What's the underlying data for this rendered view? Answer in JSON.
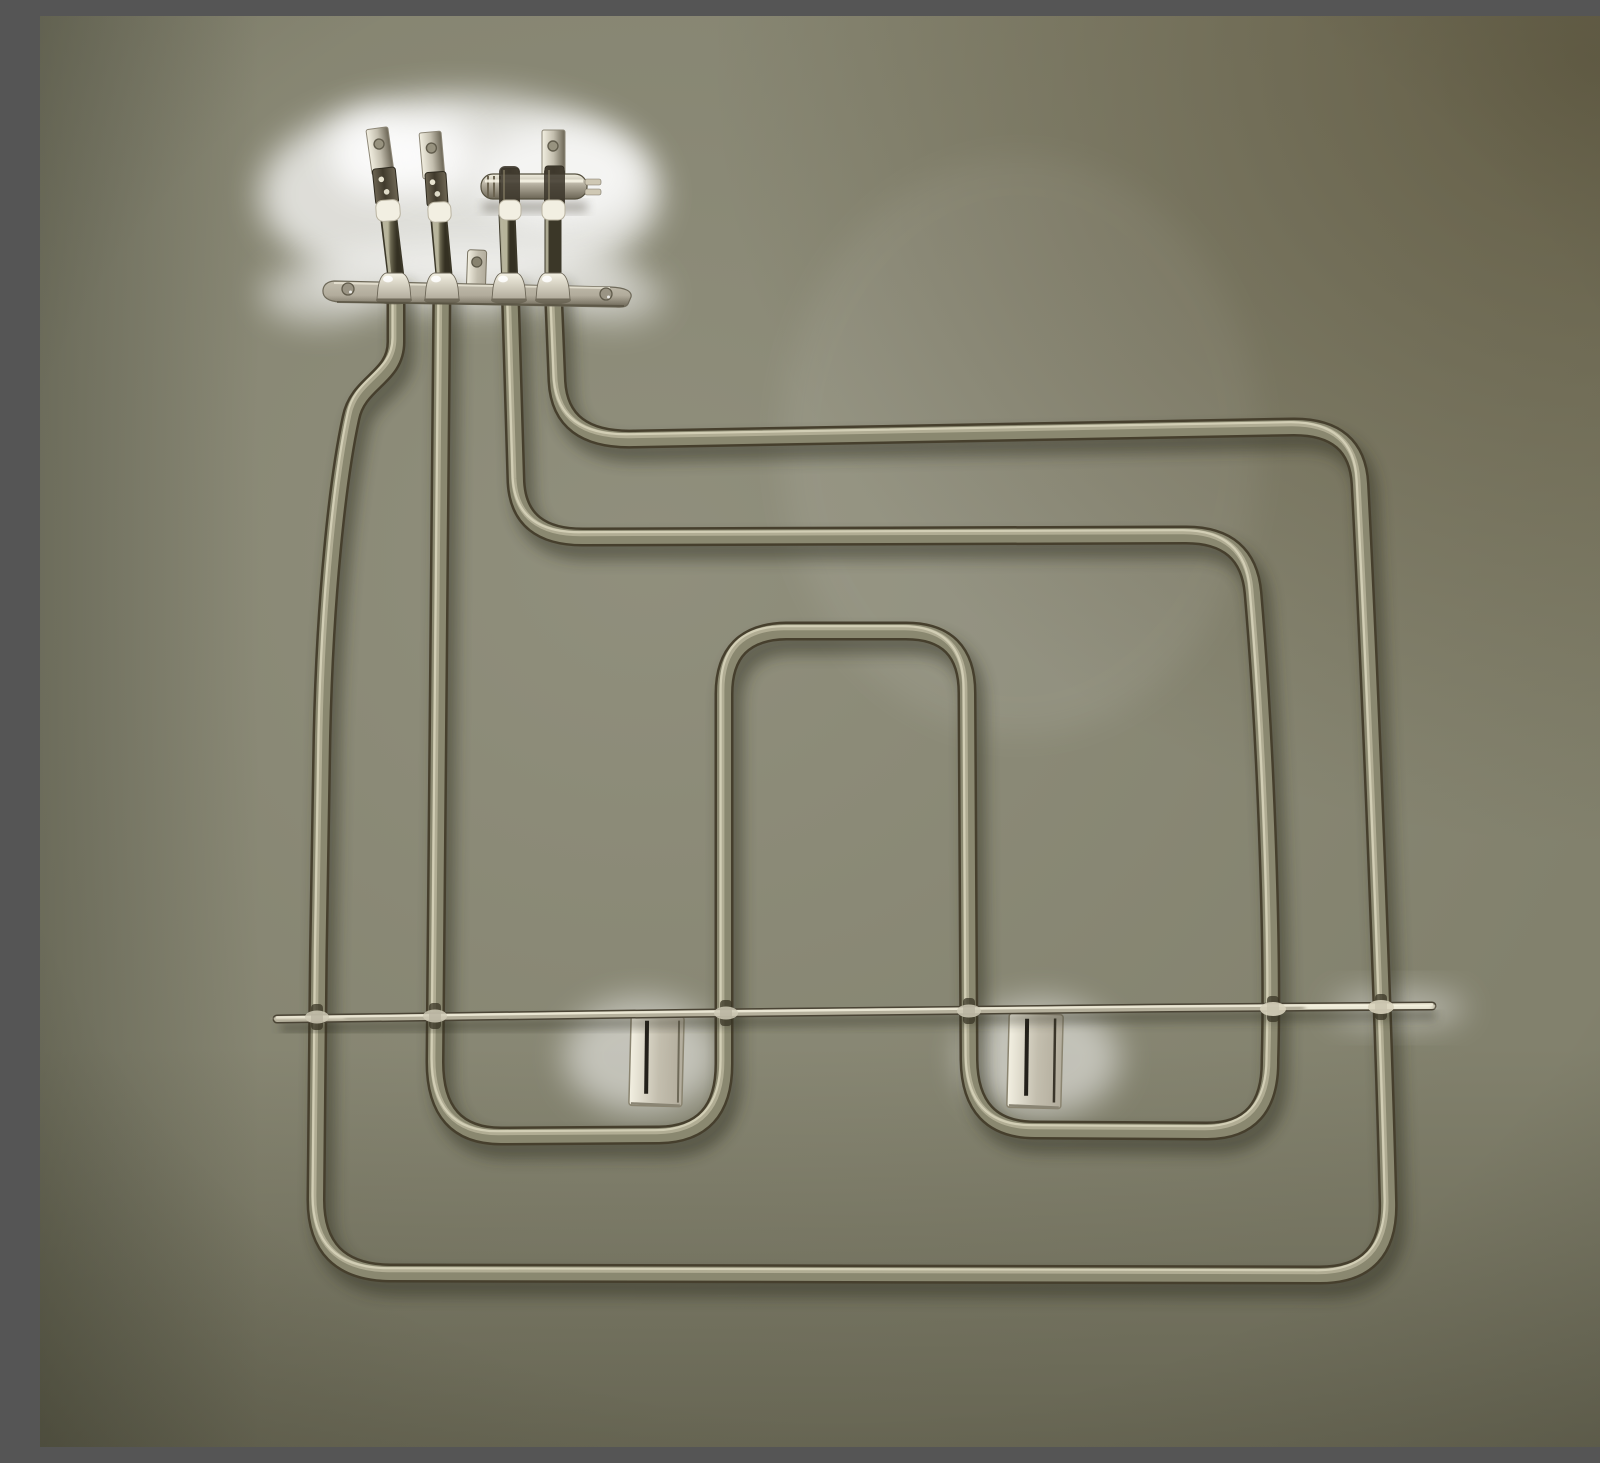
{
  "scene": {
    "description": "Photograph of a dual-circuit oven grill heating element seen against an olive-grey backdrop: four spade terminals with white ceramic ferrules on a metal mounting plate at top left, a small ribbed support pin across the two right terminals, two nested looped tube circuits (outer rectangle and inner W-shape with a raised central arch), a thin horizontal support rod near the bottom with clamps at every tube crossing, and two bright sheet-metal mounting tabs hanging from the rod",
    "object": "oven grill heating element",
    "parts": [
      "spade terminal",
      "crimp sleeve",
      "ceramic ferrule",
      "terminal mounting plate",
      "plate screw hole",
      "small mounting tab",
      "support pin",
      "outer tube circuit",
      "inner tube circuit",
      "cross support rod",
      "rod clamp",
      "mounting tab"
    ]
  },
  "colors": {
    "bg_base": "#82816d",
    "bg_light": "#959482",
    "bg_dark_corner": "#5e5a41",
    "bg_shadow": "#2e2c1d",
    "tube_edge": "#463f2d",
    "tube_base": "#8a8870",
    "tube_highlight": "#b7b49a",
    "tube_core": "#ddd9c0",
    "tube_shadow": "#2b291b",
    "rod_edge": "#4a4435",
    "rod_base": "#b5b09c",
    "rod_highlight": "#efecd9",
    "metal_bright": "#f3f0e2",
    "metal_lite": "#c3beae",
    "metal_mid": "#b2ac9c",
    "metal_dark": "#6b6555",
    "crimp_light": "#6e6654",
    "crimp": "#403a2c",
    "post": "#4c4836",
    "post_dark": "#343022",
    "post_light": "#6c6852",
    "ferrule": "#f2efe2",
    "glow": "#ffffff"
  }
}
